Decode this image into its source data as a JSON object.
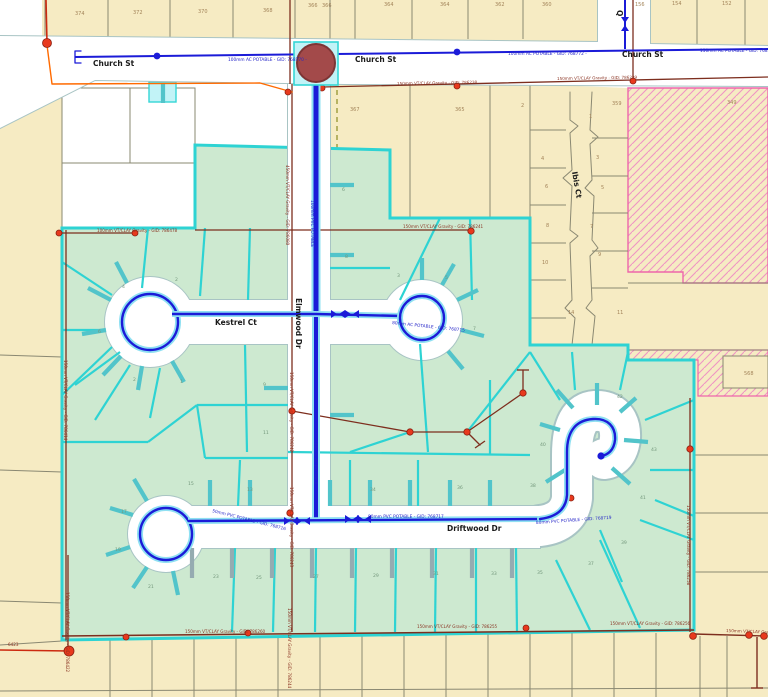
{
  "map": {
    "title": "utility-network-map",
    "street_labels": [
      {
        "text": "Church St",
        "x": 93,
        "y": 66,
        "rot": 0
      },
      {
        "text": "Church St",
        "x": 355,
        "y": 62,
        "rot": 0
      },
      {
        "text": "Church St",
        "x": 622,
        "y": 57,
        "rot": 0
      },
      {
        "text": "Kestrel Ct",
        "x": 215,
        "y": 325,
        "rot": 0
      },
      {
        "text": "Driftwood Dr",
        "x": 447,
        "y": 531,
        "rot": 0
      },
      {
        "text": "Elmwood Dr",
        "x": 296,
        "y": 298,
        "rot": 90
      },
      {
        "text": "Ibis Ct",
        "x": 572,
        "y": 172,
        "rot": 80
      },
      {
        "text": "Q",
        "x": 617,
        "y": 10,
        "rot": 90
      }
    ],
    "water_labels": [
      {
        "text": "100mm AC POTABLE - GID: 768770 -",
        "x": 228,
        "y": 61,
        "rot": 0
      },
      {
        "text": "100mm AC POTABLE - GID: 768772 -",
        "x": 508,
        "y": 55,
        "rot": 0
      },
      {
        "text": "150mm AC POTABLE - GID: 768773 -",
        "x": 700,
        "y": 52,
        "rot": 0
      },
      {
        "text": "100mm PVC POTABLE",
        "x": 311,
        "y": 200,
        "rot": 90
      },
      {
        "text": "100mm AC POTABLE",
        "x": 314,
        "y": 440,
        "rot": 90
      },
      {
        "text": "80mm AC POTABLE - GID: 768715",
        "x": 392,
        "y": 324,
        "rot": 6
      },
      {
        "text": "80mm PVC POTABLE - GID: 768717",
        "x": 368,
        "y": 518,
        "rot": 0
      },
      {
        "text": "80mm PVC POTABLE - GID: 768719",
        "x": 536,
        "y": 524,
        "rot": -4
      },
      {
        "text": "50mm PVC POTABLE - GID: 768716",
        "x": 212,
        "y": 512,
        "rot": 14
      }
    ],
    "sewer_labels": [
      {
        "text": "150mm VT/CLAY Gravity - GID: 786238",
        "x": 397,
        "y": 85,
        "rot": -1
      },
      {
        "text": "150mm VT/CLAY Gravity - GID: 786239",
        "x": 557,
        "y": 80,
        "rot": -1
      },
      {
        "text": "150mm VT/CLAY Gravity - GID: 786241",
        "x": 403,
        "y": 228,
        "rot": 0
      },
      {
        "text": "100mm VT/CLAY Gravity - GID: 786478",
        "x": 97,
        "y": 232,
        "rot": 0
      },
      {
        "text": "150mm VT/CLAY Gravity - GID: 786414",
        "x": 64,
        "y": 360,
        "rot": 90
      },
      {
        "text": "450mm VT/CLAY Gravity - GID: 786080",
        "x": 286,
        "y": 165,
        "rot": 90
      },
      {
        "text": "150mm VT/CLAY Gravity - GID: 786242",
        "x": 290,
        "y": 372,
        "rot": 90
      },
      {
        "text": "150mm VT/CLAY Gravity - GID: 786243",
        "x": 290,
        "y": 487,
        "rot": 90
      },
      {
        "text": "150mm VT/CLAY Gravity - GID: 786244",
        "x": 288,
        "y": 608,
        "rot": 90
      },
      {
        "text": "150mm VT/CLAY Gravity - GID: 786260",
        "x": 185,
        "y": 633,
        "rot": 0
      },
      {
        "text": "150mm VT/CLAY Gravity - GID: 786255",
        "x": 417,
        "y": 628,
        "rot": 0
      },
      {
        "text": "150mm VT/CLAY Gravity - GID: 786256",
        "x": 610,
        "y": 625,
        "rot": 0
      },
      {
        "text": "150mm VT/CLAY Gravity - GID: 786257",
        "x": 726,
        "y": 632,
        "rot": 2
      },
      {
        "text": "150mm VT/CLAY Gravity - GID: 786258",
        "x": 687,
        "y": 505,
        "rot": 90
      },
      {
        "text": "150mm VT/CLAY Gravity - GID: 786422",
        "x": 66,
        "y": 592,
        "rot": 90
      },
      {
        "text": "6423",
        "x": 8,
        "y": 646,
        "rot": 0
      }
    ],
    "parcel_labels_tan": [
      {
        "text": "374",
        "x": 75,
        "y": 15
      },
      {
        "text": "372",
        "x": 133,
        "y": 14
      },
      {
        "text": "370",
        "x": 198,
        "y": 13
      },
      {
        "text": "368",
        "x": 263,
        "y": 12
      },
      {
        "text": "366",
        "x": 308,
        "y": 7
      },
      {
        "text": "366",
        "x": 322,
        "y": 7
      },
      {
        "text": "364",
        "x": 384,
        "y": 6
      },
      {
        "text": "364",
        "x": 440,
        "y": 6
      },
      {
        "text": "362",
        "x": 495,
        "y": 6
      },
      {
        "text": "360",
        "x": 542,
        "y": 6
      },
      {
        "text": "156",
        "x": 635,
        "y": 6
      },
      {
        "text": "154",
        "x": 672,
        "y": 5
      },
      {
        "text": "152",
        "x": 722,
        "y": 5
      },
      {
        "text": "367",
        "x": 350,
        "y": 111
      },
      {
        "text": "365",
        "x": 455,
        "y": 111
      },
      {
        "text": "359",
        "x": 612,
        "y": 105
      },
      {
        "text": "349",
        "x": 727,
        "y": 104
      },
      {
        "text": "568",
        "x": 744,
        "y": 375
      },
      {
        "text": "2",
        "x": 521,
        "y": 107
      },
      {
        "text": "1",
        "x": 589,
        "y": 118
      },
      {
        "text": "4",
        "x": 541,
        "y": 160
      },
      {
        "text": "3",
        "x": 596,
        "y": 159
      },
      {
        "text": "6",
        "x": 545,
        "y": 188
      },
      {
        "text": "5",
        "x": 601,
        "y": 189
      },
      {
        "text": "8",
        "x": 546,
        "y": 227
      },
      {
        "text": "7",
        "x": 590,
        "y": 228
      },
      {
        "text": "10",
        "x": 542,
        "y": 264
      },
      {
        "text": "9",
        "x": 598,
        "y": 256
      },
      {
        "text": "14",
        "x": 568,
        "y": 314
      },
      {
        "text": "11",
        "x": 617,
        "y": 314
      }
    ],
    "parcel_labels_green": [
      {
        "text": "6",
        "x": 342,
        "y": 191
      },
      {
        "text": "8",
        "x": 345,
        "y": 258
      },
      {
        "text": "3",
        "x": 397,
        "y": 277
      },
      {
        "text": "5",
        "x": 445,
        "y": 279
      },
      {
        "text": "7",
        "x": 473,
        "y": 330
      },
      {
        "text": "4",
        "x": 122,
        "y": 288
      },
      {
        "text": "2",
        "x": 175,
        "y": 281
      },
      {
        "text": "6",
        "x": 98,
        "y": 333
      },
      {
        "text": "1",
        "x": 180,
        "y": 383
      },
      {
        "text": "2",
        "x": 133,
        "y": 381
      },
      {
        "text": "9",
        "x": 263,
        "y": 386
      },
      {
        "text": "11",
        "x": 263,
        "y": 434
      },
      {
        "text": "13",
        "x": 247,
        "y": 491
      },
      {
        "text": "15",
        "x": 188,
        "y": 485
      },
      {
        "text": "17",
        "x": 121,
        "y": 513
      },
      {
        "text": "19",
        "x": 115,
        "y": 551
      },
      {
        "text": "21",
        "x": 148,
        "y": 588
      },
      {
        "text": "23",
        "x": 213,
        "y": 578
      },
      {
        "text": "25",
        "x": 256,
        "y": 579
      },
      {
        "text": "27",
        "x": 313,
        "y": 578
      },
      {
        "text": "29",
        "x": 373,
        "y": 577
      },
      {
        "text": "31",
        "x": 433,
        "y": 575
      },
      {
        "text": "33",
        "x": 491,
        "y": 575
      },
      {
        "text": "35",
        "x": 537,
        "y": 574
      },
      {
        "text": "37",
        "x": 588,
        "y": 565
      },
      {
        "text": "39",
        "x": 621,
        "y": 544
      },
      {
        "text": "34",
        "x": 370,
        "y": 491
      },
      {
        "text": "36",
        "x": 457,
        "y": 489
      },
      {
        "text": "38",
        "x": 530,
        "y": 487
      },
      {
        "text": "40",
        "x": 540,
        "y": 446
      },
      {
        "text": "41",
        "x": 640,
        "y": 499
      },
      {
        "text": "42",
        "x": 617,
        "y": 398
      },
      {
        "text": "43",
        "x": 651,
        "y": 451
      }
    ],
    "colors": {
      "parcel_tan": "#f6ebc3",
      "parcel_green": "#cde9d0",
      "cadastre_line": "#8a8872",
      "subdivision_boundary": "#2ed3d3",
      "lateral_teal": "#52c4ca",
      "lateral_gray": "#95abb1",
      "water_blue": "#1b1bd8",
      "water_casing": "#8fe0f2",
      "sewer_brown": "#7d2e1e",
      "node_red": "#e8391d",
      "orange_boundary": "#ff6a00",
      "pink_hatch": "#ef95c3",
      "reservoir_fill": "#a34a4a",
      "highlight_cyan": "#c2f3f7",
      "street_edge": "#a8c4c4",
      "dashed_easement": "#9a9a3a"
    }
  }
}
